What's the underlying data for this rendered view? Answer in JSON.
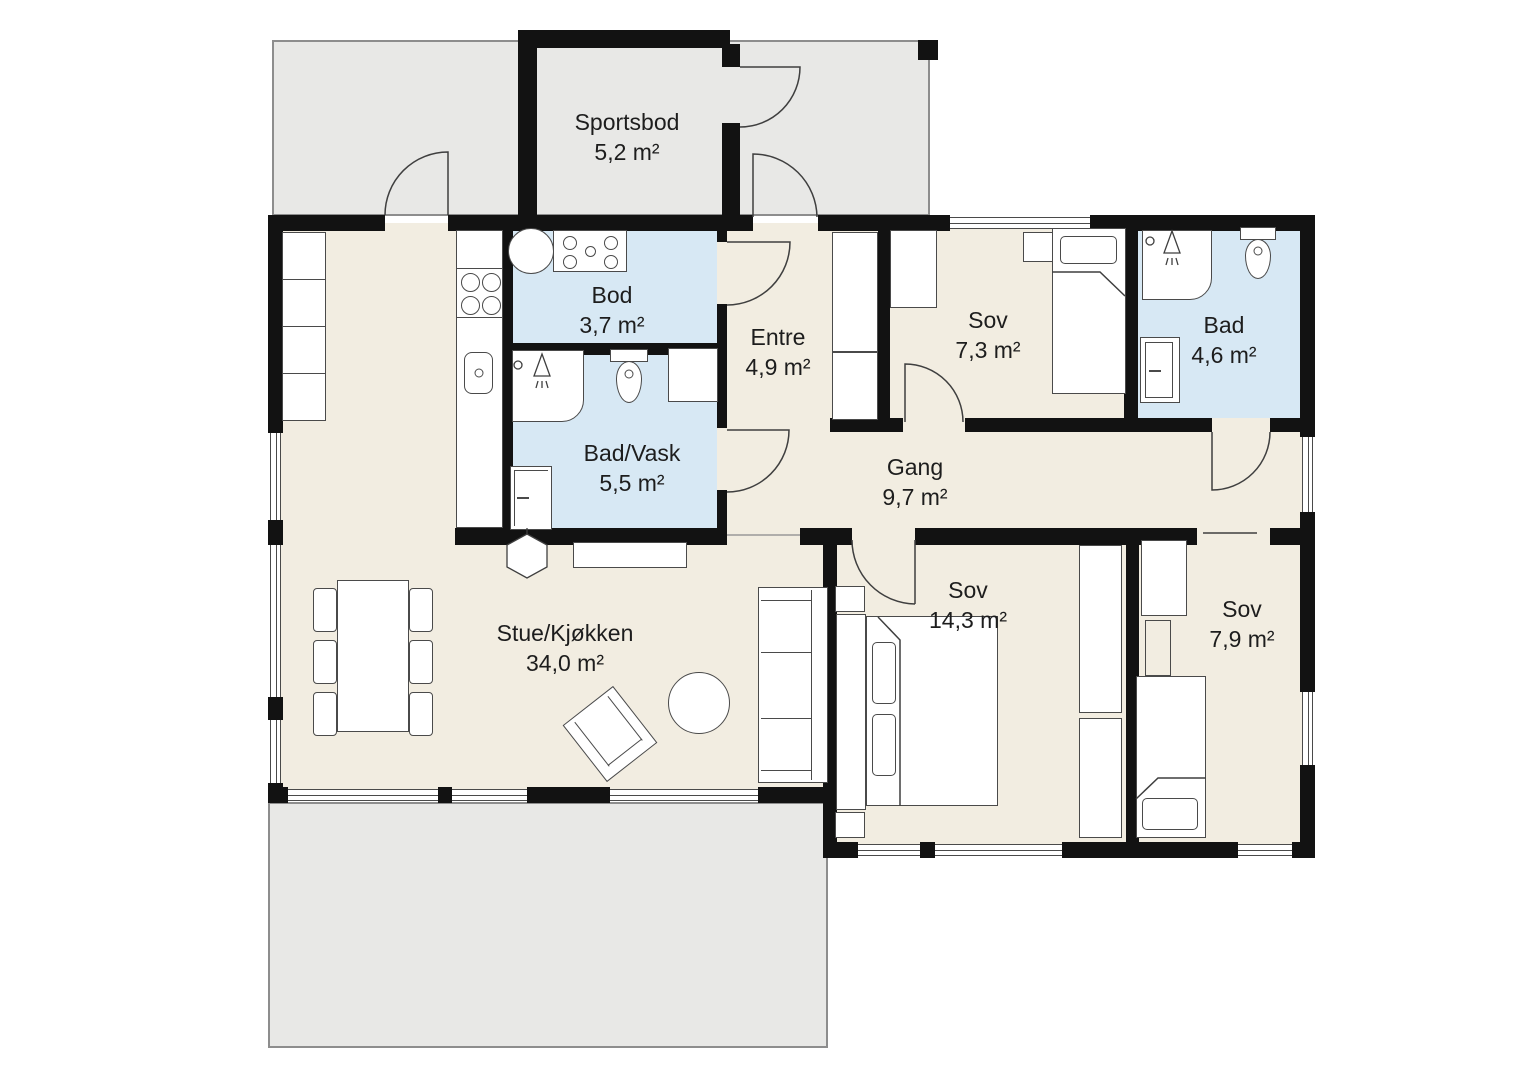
{
  "plan_title": "Floor plan",
  "rooms": [
    {
      "id": "sportsbod",
      "name": "Sportsbod",
      "area": "5,2 m²",
      "type": "outdoor-storage"
    },
    {
      "id": "bod",
      "name": "Bod",
      "area": "3,7 m²",
      "type": "storage"
    },
    {
      "id": "bad-vask",
      "name": "Bad/Vask",
      "area": "5,5 m²",
      "type": "bathroom-laundry"
    },
    {
      "id": "entre",
      "name": "Entre",
      "area": "4,9 m²",
      "type": "entry"
    },
    {
      "id": "sov-1",
      "name": "Sov",
      "area": "7,3 m²",
      "type": "bedroom"
    },
    {
      "id": "bad",
      "name": "Bad",
      "area": "4,6 m²",
      "type": "bathroom"
    },
    {
      "id": "gang",
      "name": "Gang",
      "area": "9,7 m²",
      "type": "hallway"
    },
    {
      "id": "stue-kjokken",
      "name": "Stue/Kjøkken",
      "area": "34,0 m²",
      "type": "living-kitchen"
    },
    {
      "id": "sov-2",
      "name": "Sov",
      "area": "14,3 m²",
      "type": "bedroom"
    },
    {
      "id": "sov-3",
      "name": "Sov",
      "area": "7,9 m²",
      "type": "bedroom"
    }
  ],
  "colors": {
    "floor": "#f2ede1",
    "wet_room": "#d7e8f4",
    "outdoor": "#e8e8e6",
    "wall": "#121212",
    "furniture_stroke": "#4a4a4a",
    "label_text": "#1d1d1d"
  }
}
